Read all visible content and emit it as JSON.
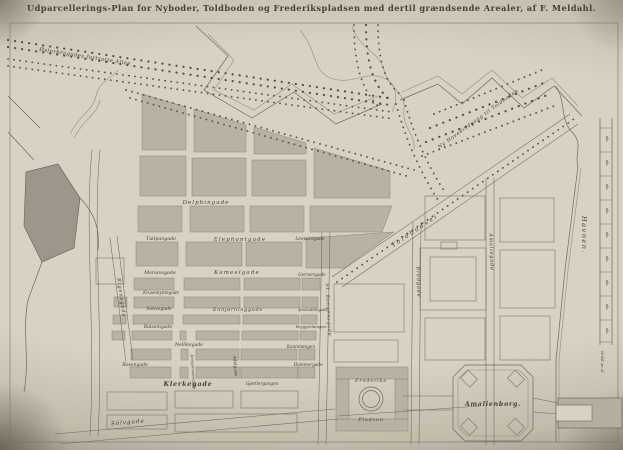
{
  "title": "Udparcellerings-Plan for Nyboder, Toldboden og Frederikspladsen med dertil grændsende Arealer, af F. Meldahl.",
  "colors": {
    "paper": "#d9d2c2",
    "ink": "#46413a",
    "block": "#b9b1a1",
    "dark_area": "#9d968a"
  },
  "labels": {
    "osterbro_allee": "Østerbrogades fortsatte Allee",
    "ny_hovedindgang": "Ny Hovedindgang til Toldboden",
    "toldbodvei": "Toldbodvei",
    "havnen": "Havnen.",
    "amalienborg": "Amalienborg.",
    "frederiks": "Frederiks",
    "pladsen": "Pladsen",
    "amaliegade": "Amaliegade",
    "bredgade": "Bredgade",
    "st_kongensgade": "St. Kongensgade",
    "adelgade": "Adelgade",
    "kronprinsessegade": "Kronprinsessegade",
    "rigensgade": "Rigensgade",
    "delphingade": "Delphingade",
    "tulipangade": "Tulipangade",
    "elephantgade": "Elephantgade",
    "leopardgade": "Leopardgade",
    "meriansgade": "Meriansgade",
    "kameelgade": "Kameelgade",
    "gernersgade": "Gernersgade",
    "krusemyntegade": "Krusemyntegade",
    "salviegade": "Salviegade",
    "enhjorninggade": "Enhjørninggade",
    "krokodillegade": "Krokodillegade",
    "balsamgade": "Balsamgade",
    "bryggerlaengen": "Bryggerlængen",
    "nellikegade": "Nellikegade",
    "kaninlaengen": "Kaninlængen",
    "rosengade": "Rosengade",
    "hummergade": "Hummergade",
    "klerkegade": "Klerkegade",
    "gjortlergangen": "Gjørtlergangen",
    "solvgade": "Sölvgade",
    "quay_tick": "ale.",
    "price_note": "60 Rdl. pr. Al."
  }
}
